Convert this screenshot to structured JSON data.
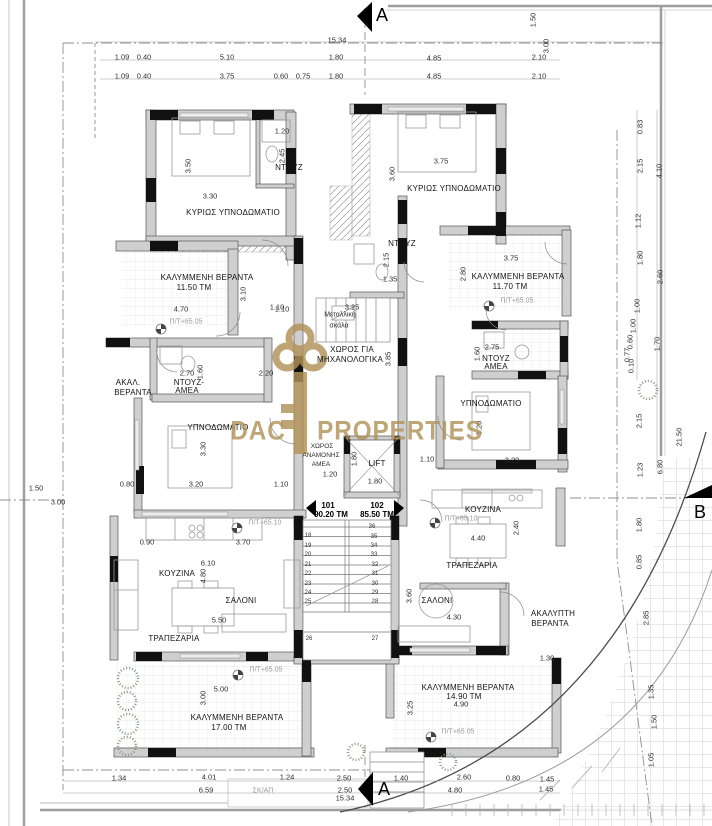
{
  "palette": {
    "accent_gold": "#b29258",
    "wall_black": "#111111",
    "wall_gray": "#cfcfcf",
    "line_gray": "#9e9e9e"
  },
  "units": [
    {
      "number": "101",
      "area": "90.20 ΤΜ"
    },
    {
      "number": "102",
      "area": "85.50 ΤΜ"
    }
  ],
  "texts": [
    {
      "t": "A",
      "x": 382,
      "y": 15,
      "c": "m"
    },
    {
      "t": "A",
      "x": 384,
      "y": 789,
      "c": "m"
    },
    {
      "t": "B",
      "x": 700,
      "y": 512,
      "c": "m"
    },
    {
      "t": "15.34",
      "x": 337,
      "y": 40,
      "c": "d"
    },
    {
      "t": "1.09",
      "x": 122,
      "y": 57,
      "c": "d"
    },
    {
      "t": "0.40",
      "x": 144,
      "y": 57,
      "c": "d"
    },
    {
      "t": "5.10",
      "x": 227,
      "y": 57,
      "c": "d"
    },
    {
      "t": "1.80",
      "x": 336,
      "y": 57,
      "c": "d"
    },
    {
      "t": "4.85",
      "x": 434,
      "y": 58,
      "c": "d"
    },
    {
      "t": "2.10",
      "x": 539,
      "y": 57,
      "c": "d"
    },
    {
      "t": "1.09",
      "x": 122,
      "y": 76,
      "c": "d"
    },
    {
      "t": "0.40",
      "x": 144,
      "y": 76,
      "c": "d"
    },
    {
      "t": "3.75",
      "x": 227,
      "y": 76,
      "c": "d"
    },
    {
      "t": "0.60",
      "x": 281,
      "y": 76,
      "c": "d"
    },
    {
      "t": "0.75",
      "x": 303,
      "y": 76,
      "c": "d"
    },
    {
      "t": "1.80",
      "x": 336,
      "y": 76,
      "c": "d"
    },
    {
      "t": "4.85",
      "x": 434,
      "y": 76,
      "c": "d"
    },
    {
      "t": "2.10",
      "x": 539,
      "y": 76,
      "c": "d"
    },
    {
      "t": "1.50",
      "x": 533,
      "y": 20,
      "c": "dv"
    },
    {
      "t": "3.00",
      "x": 546,
      "y": 46,
      "c": "dv"
    },
    {
      "t": "0.83",
      "x": 640,
      "y": 127,
      "c": "dv"
    },
    {
      "t": "2.15",
      "x": 640,
      "y": 166,
      "c": "dv"
    },
    {
      "t": "4.10",
      "x": 659,
      "y": 171,
      "c": "dv"
    },
    {
      "t": "1.12",
      "x": 638,
      "y": 221,
      "c": "dv"
    },
    {
      "t": "1.80",
      "x": 640,
      "y": 258,
      "c": "dv"
    },
    {
      "t": "2.60",
      "x": 660,
      "y": 277,
      "c": "dv"
    },
    {
      "t": "1.00",
      "x": 637,
      "y": 306,
      "c": "dv"
    },
    {
      "t": "1.00",
      "x": 633,
      "y": 326,
      "c": "dv"
    },
    {
      "t": "0.60",
      "x": 630,
      "y": 342,
      "c": "dv"
    },
    {
      "t": "0.77",
      "x": 627,
      "y": 355,
      "c": "dv"
    },
    {
      "t": "0.10",
      "x": 631,
      "y": 366,
      "c": "dv"
    },
    {
      "t": "1.70",
      "x": 657,
      "y": 344,
      "c": "dv"
    },
    {
      "t": "2.15",
      "x": 639,
      "y": 421,
      "c": "dv"
    },
    {
      "t": "1.23",
      "x": 640,
      "y": 470,
      "c": "dv"
    },
    {
      "t": "6.80",
      "x": 660,
      "y": 467,
      "c": "dv"
    },
    {
      "t": "21.50",
      "x": 679,
      "y": 437,
      "c": "dv"
    },
    {
      "t": "1.80",
      "x": 639,
      "y": 525,
      "c": "dv"
    },
    {
      "t": "0.85",
      "x": 639,
      "y": 562,
      "c": "dv"
    },
    {
      "t": "2.85",
      "x": 646,
      "y": 618,
      "c": "dv"
    },
    {
      "t": "1.35",
      "x": 651,
      "y": 692,
      "c": "dv"
    },
    {
      "t": "1.50",
      "x": 654,
      "y": 722,
      "c": "dv"
    },
    {
      "t": "1.05",
      "x": 651,
      "y": 760,
      "c": "dv"
    },
    {
      "t": "1.50",
      "x": 36,
      "y": 488,
      "c": "d"
    },
    {
      "t": "3.00",
      "x": 58,
      "y": 502,
      "c": "d"
    },
    {
      "t": "1.34",
      "x": 119,
      "y": 778,
      "c": "d"
    },
    {
      "t": "4.01",
      "x": 209,
      "y": 777,
      "c": "d"
    },
    {
      "t": "1.24",
      "x": 287,
      "y": 777,
      "c": "d"
    },
    {
      "t": "2.50",
      "x": 344,
      "y": 778,
      "c": "d"
    },
    {
      "t": "1.40",
      "x": 401,
      "y": 778,
      "c": "d"
    },
    {
      "t": "2.60",
      "x": 464,
      "y": 777,
      "c": "d"
    },
    {
      "t": "0.80",
      "x": 513,
      "y": 778,
      "c": "d"
    },
    {
      "t": "1.45",
      "x": 547,
      "y": 779,
      "c": "d"
    },
    {
      "t": "6.59",
      "x": 206,
      "y": 790,
      "c": "d"
    },
    {
      "t": "ΣΚ/ΑΠ",
      "x": 263,
      "y": 791,
      "c": "g"
    },
    {
      "t": "2.50",
      "x": 345,
      "y": 790,
      "c": "d"
    },
    {
      "t": "4.80",
      "x": 455,
      "y": 790,
      "c": "d"
    },
    {
      "t": "1.45",
      "x": 546,
      "y": 789,
      "c": "d"
    },
    {
      "t": "15.34",
      "x": 345,
      "y": 798,
      "c": "d"
    },
    {
      "t": "101",
      "x": 328,
      "y": 506,
      "c": "u"
    },
    {
      "t": "90.20 ΤΜ",
      "x": 331,
      "y": 515,
      "c": "u"
    },
    {
      "t": "102",
      "x": 377,
      "y": 506,
      "c": "u"
    },
    {
      "t": "85.50 ΤΜ",
      "x": 377,
      "y": 515,
      "c": "u"
    },
    {
      "t": "ΚΥΡΙΩΣ ΥΠΝΟΔΩΜΑΤΙΟ",
      "x": 233,
      "y": 213,
      "c": "r"
    },
    {
      "t": "ΝΤΟΥΖ",
      "x": 289,
      "y": 168,
      "c": "r"
    },
    {
      "t": "3.50",
      "x": 188,
      "y": 166,
      "c": "dv"
    },
    {
      "t": "3.30",
      "x": 210,
      "y": 196,
      "c": "d"
    },
    {
      "t": "1.20",
      "x": 282,
      "y": 131,
      "c": "d"
    },
    {
      "t": "2.45",
      "x": 282,
      "y": 156,
      "c": "dv"
    },
    {
      "t": "ΚΥΡΙΩΣ ΥΠΝΟΔΩΜΑΤΙΟ",
      "x": 454,
      "y": 189,
      "c": "r"
    },
    {
      "t": "3.75",
      "x": 441,
      "y": 161,
      "c": "d"
    },
    {
      "t": "3.60",
      "x": 392,
      "y": 174,
      "c": "dv"
    },
    {
      "t": "ΝΤΟΥΖ",
      "x": 402,
      "y": 244,
      "c": "r"
    },
    {
      "t": "2.15",
      "x": 386,
      "y": 260,
      "c": "dv"
    },
    {
      "t": "1.35",
      "x": 390,
      "y": 279,
      "c": "d"
    },
    {
      "t": "ΚΑΛΥΜΜΕΝΗ ΒΕΡΑΝΤΑ",
      "x": 207,
      "y": 278,
      "c": "r"
    },
    {
      "t": "11.50 ΤΜ",
      "x": 194,
      "y": 288,
      "c": "r"
    },
    {
      "t": "4.70",
      "x": 181,
      "y": 309,
      "c": "d"
    },
    {
      "t": "3.10",
      "x": 243,
      "y": 294,
      "c": "dv"
    },
    {
      "t": "1.10",
      "x": 282,
      "y": 309,
      "c": "d"
    },
    {
      "t": "Π/Τ+65.05",
      "x": 186,
      "y": 322,
      "c": "g"
    },
    {
      "t": "ΚΑΛΥΜΜΕΝΗ ΒΕΡΑΝΤΑ",
      "x": 518,
      "y": 277,
      "c": "r"
    },
    {
      "t": "11.70 ΤΜ",
      "x": 510,
      "y": 287,
      "c": "r"
    },
    {
      "t": "3.75",
      "x": 511,
      "y": 258,
      "c": "d"
    },
    {
      "t": "2.80",
      "x": 463,
      "y": 274,
      "c": "dv"
    },
    {
      "t": "Π/Τ+65.05",
      "x": 517,
      "y": 301,
      "c": "g"
    },
    {
      "t": "Μεταλλική",
      "x": 340,
      "y": 315,
      "c": "sm"
    },
    {
      "t": "σκάλα",
      "x": 339,
      "y": 326,
      "c": "sm"
    },
    {
      "t": "3.25",
      "x": 352,
      "y": 307,
      "c": "d"
    },
    {
      "t": "1.10",
      "x": 277,
      "y": 307,
      "c": "d"
    },
    {
      "t": "ΧΩΡΟΣ ΓΙΑ",
      "x": 352,
      "y": 350,
      "c": "r"
    },
    {
      "t": "ΜΗΧΑΝΟΛΟΓΙΚΑ",
      "x": 350,
      "y": 360,
      "c": "r"
    },
    {
      "t": "3.85",
      "x": 388,
      "y": 359,
      "c": "dv"
    },
    {
      "t": "ΑΚΑΛ.",
      "x": 128,
      "y": 383,
      "c": "r"
    },
    {
      "t": "ΒΕΡΑΝΤΑ",
      "x": 133,
      "y": 393,
      "c": "r"
    },
    {
      "t": "ΝΤΟΥΖ-",
      "x": 189,
      "y": 383,
      "c": "r"
    },
    {
      "t": "ΑΜΕΑ",
      "x": 187,
      "y": 391,
      "c": "r"
    },
    {
      "t": "2.70",
      "x": 187,
      "y": 373,
      "c": "d"
    },
    {
      "t": "1.60",
      "x": 200,
      "y": 372,
      "c": "dv"
    },
    {
      "t": "2.20",
      "x": 266,
      "y": 373,
      "c": "d"
    },
    {
      "t": "ΝΤΟΥΖ",
      "x": 496,
      "y": 359,
      "c": "r"
    },
    {
      "t": "ΑΜΕΑ",
      "x": 496,
      "y": 367,
      "c": "r"
    },
    {
      "t": "2.75",
      "x": 492,
      "y": 347,
      "c": "d"
    },
    {
      "t": "1.60",
      "x": 477,
      "y": 354,
      "c": "dv"
    },
    {
      "t": "ΥΠΝΟΔΩΜΑΤΙΟ",
      "x": 218,
      "y": 428,
      "c": "r"
    },
    {
      "t": "3.30",
      "x": 203,
      "y": 449,
      "c": "dv"
    },
    {
      "t": "3.20",
      "x": 196,
      "y": 484,
      "c": "d"
    },
    {
      "t": "0.80",
      "x": 127,
      "y": 484,
      "c": "d"
    },
    {
      "t": "1.10",
      "x": 281,
      "y": 484,
      "c": "d"
    },
    {
      "t": "ΥΠΝΟΔΩΜΑΤΙΟ",
      "x": 491,
      "y": 404,
      "c": "r"
    },
    {
      "t": "3.20",
      "x": 479,
      "y": 428,
      "c": "dv"
    },
    {
      "t": "3.20",
      "x": 512,
      "y": 460,
      "c": "d"
    },
    {
      "t": "ΧΩΡΟΣ",
      "x": 322,
      "y": 447,
      "c": "sm2"
    },
    {
      "t": "ΑΝΑΜΟΝΗΣ",
      "x": 321,
      "y": 456,
      "c": "sm2"
    },
    {
      "t": "ΑΜΕΑ",
      "x": 321,
      "y": 465,
      "c": "sm2"
    },
    {
      "t": "1.20",
      "x": 330,
      "y": 474,
      "c": "d"
    },
    {
      "t": "LIFT",
      "x": 377,
      "y": 464,
      "c": "r"
    },
    {
      "t": "1.80",
      "x": 354,
      "y": 459,
      "c": "dv"
    },
    {
      "t": "1.80",
      "x": 375,
      "y": 481,
      "c": "d"
    },
    {
      "t": "1.10",
      "x": 427,
      "y": 459,
      "c": "d"
    },
    {
      "t": "ΚΟΥΖΙΝΑ",
      "x": 483,
      "y": 510,
      "c": "r"
    },
    {
      "t": "Π/Τ+65.10",
      "x": 461,
      "y": 519,
      "c": "g"
    },
    {
      "t": "4.40",
      "x": 478,
      "y": 538,
      "c": "d"
    },
    {
      "t": "2.40",
      "x": 516,
      "y": 528,
      "c": "dv"
    },
    {
      "t": "ΤΡΑΠΕΖΑΡΙΑ",
      "x": 472,
      "y": 566,
      "c": "r"
    },
    {
      "t": "ΚΟΥΖΙΝΑ",
      "x": 177,
      "y": 574,
      "c": "r"
    },
    {
      "t": "0.90",
      "x": 147,
      "y": 542,
      "c": "d"
    },
    {
      "t": "3.70",
      "x": 243,
      "y": 542,
      "c": "d"
    },
    {
      "t": "6.10",
      "x": 208,
      "y": 563,
      "c": "d"
    },
    {
      "t": "4.80",
      "x": 203,
      "y": 576,
      "c": "dv"
    },
    {
      "t": "Π/Τ+65.10",
      "x": 265,
      "y": 523,
      "c": "g"
    },
    {
      "t": "ΣΑΛΟΝΙ",
      "x": 241,
      "y": 601,
      "c": "r"
    },
    {
      "t": "5.50",
      "x": 219,
      "y": 620,
      "c": "d"
    },
    {
      "t": "ΤΡΑΠΕΖΑΡΙΑ",
      "x": 174,
      "y": 639,
      "c": "r"
    },
    {
      "t": "Π/Τ+65.05",
      "x": 266,
      "y": 670,
      "c": "g"
    },
    {
      "t": "5.00",
      "x": 221,
      "y": 689,
      "c": "d"
    },
    {
      "t": "3.00",
      "x": 203,
      "y": 698,
      "c": "dv"
    },
    {
      "t": "ΚΑΛΥΜΜΕΝΗ ΒΕΡΑΝΤΑ",
      "x": 237,
      "y": 718,
      "c": "r"
    },
    {
      "t": "17.00 ΤΜ",
      "x": 229,
      "y": 728,
      "c": "r"
    },
    {
      "t": "ΣΑΛΟΝΙ",
      "x": 437,
      "y": 601,
      "c": "r"
    },
    {
      "t": "3.60",
      "x": 409,
      "y": 596,
      "c": "dv"
    },
    {
      "t": "4.30",
      "x": 454,
      "y": 617,
      "c": "d"
    },
    {
      "t": "ΑΚΑΛΥΠΤΗ",
      "x": 553,
      "y": 614,
      "c": "r"
    },
    {
      "t": "ΒΕΡΑΝΤΑ",
      "x": 550,
      "y": 624,
      "c": "r"
    },
    {
      "t": "1.30",
      "x": 547,
      "y": 658,
      "c": "d"
    },
    {
      "t": "ΚΑΛΥΜΜΕΝΗ ΒΕΡΑΝΤΑ",
      "x": 468,
      "y": 688,
      "c": "r"
    },
    {
      "t": "14.90 ΤΜ",
      "x": 464,
      "y": 697,
      "c": "r"
    },
    {
      "t": "4.90",
      "x": 461,
      "y": 704,
      "c": "d"
    },
    {
      "t": "3.25",
      "x": 410,
      "y": 708,
      "c": "dv"
    },
    {
      "t": "Π/Τ+65.05",
      "x": 458,
      "y": 732,
      "c": "g"
    },
    {
      "t": "18",
      "x": 308,
      "y": 536,
      "c": "n"
    },
    {
      "t": "19",
      "x": 308,
      "y": 546,
      "c": "n"
    },
    {
      "t": "20",
      "x": 308,
      "y": 555,
      "c": "n"
    },
    {
      "t": "21",
      "x": 308,
      "y": 565,
      "c": "n"
    },
    {
      "t": "22",
      "x": 308,
      "y": 574,
      "c": "n"
    },
    {
      "t": "23",
      "x": 308,
      "y": 584,
      "c": "n"
    },
    {
      "t": "24",
      "x": 308,
      "y": 593,
      "c": "n"
    },
    {
      "t": "25",
      "x": 308,
      "y": 602,
      "c": "n"
    },
    {
      "t": "26",
      "x": 309,
      "y": 639,
      "c": "n"
    },
    {
      "t": "27",
      "x": 375,
      "y": 639,
      "c": "n"
    },
    {
      "t": "28",
      "x": 375,
      "y": 602,
      "c": "n"
    },
    {
      "t": "29",
      "x": 375,
      "y": 593,
      "c": "n"
    },
    {
      "t": "30",
      "x": 375,
      "y": 584,
      "c": "n"
    },
    {
      "t": "31",
      "x": 375,
      "y": 574,
      "c": "n"
    },
    {
      "t": "32",
      "x": 375,
      "y": 565,
      "c": "n"
    },
    {
      "t": "33",
      "x": 374,
      "y": 555,
      "c": "n"
    },
    {
      "t": "34",
      "x": 374,
      "y": 546,
      "c": "n"
    },
    {
      "t": "35",
      "x": 374,
      "y": 537,
      "c": "n"
    },
    {
      "t": "36",
      "x": 372,
      "y": 527,
      "c": "n"
    },
    {
      "t": "DAC",
      "x": 258,
      "y": 431,
      "c": "w"
    },
    {
      "t": "PROPERTIES",
      "x": 400,
      "y": 431,
      "c": "w"
    }
  ]
}
